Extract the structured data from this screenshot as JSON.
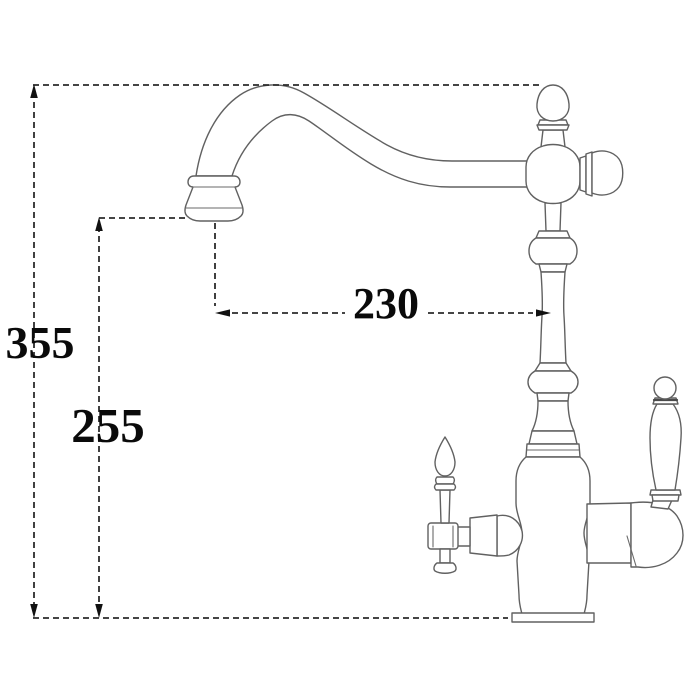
{
  "diagram": {
    "type": "technical-dimension-drawing",
    "subject": "kitchen-faucet-side-view-line-art",
    "background_color": "#ffffff",
    "outline_color": "#616161",
    "dimension_line_color": "#2b2b2b",
    "dimension_text_color": "#0a0a0a",
    "dimensions": {
      "overall_height": "355",
      "spout_outlet_height": "255",
      "spout_reach": "230"
    }
  }
}
